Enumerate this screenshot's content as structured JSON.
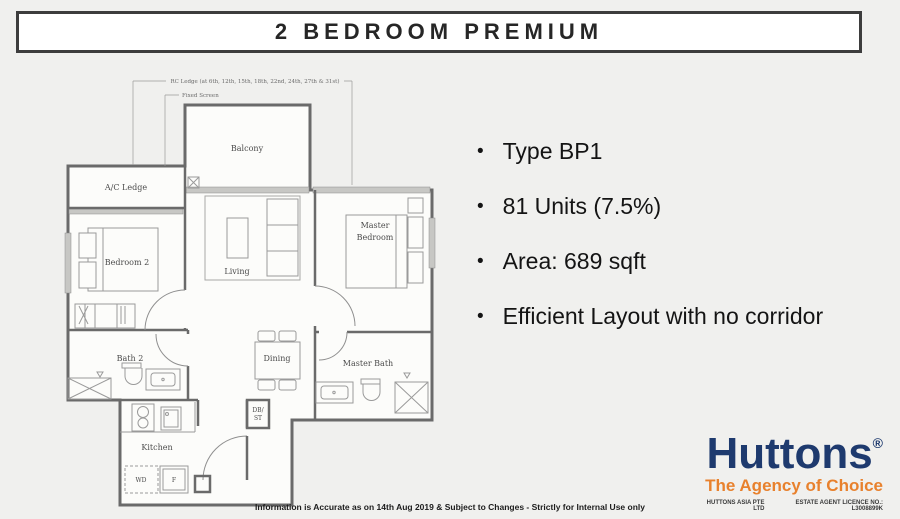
{
  "page": {
    "bg": "#f0f0ee"
  },
  "header": {
    "title": "2 BEDROOM PREMIUM"
  },
  "floor_plan": {
    "annotations": {
      "rc_ledge": "RC Ledge (at 6th, 12th, 15th, 18th, 22nd, 24th, 27th & 31st)",
      "fixed_screen": "Fixed Screen"
    },
    "rooms": {
      "balcony": "Balcony",
      "ac_ledge": "A/C Ledge",
      "bedroom2": "Bedroom 2",
      "living": "Living",
      "master_line1": "Master",
      "master_line2": "Bedroom",
      "bath2": "Bath 2",
      "dining": "Dining",
      "master_bath": "Master Bath",
      "kitchen": "Kitchen",
      "db_line1": "DB/",
      "db_line2": "ST",
      "wd": "WD",
      "fridge": "F"
    }
  },
  "details": {
    "bullet": "•",
    "items": [
      "Type BP1",
      "81 Units (7.5%)",
      "Area: 689 sqft",
      "Efficient Layout with no corridor"
    ]
  },
  "footer": {
    "disclaimer": "Information is Accurate as on 14th Aug 2019 & Subject to Changes - Strictly for Internal Use only"
  },
  "logo": {
    "brand": "Huttons",
    "registered": "®",
    "tagline": "The Agency of Choice",
    "company": "HUTTONS ASIA PTE LTD",
    "licence": "ESTATE AGENT LICENCE NO.: L3008899K",
    "colors": {
      "navy": "#1e3a6e",
      "orange": "#e8812d"
    }
  }
}
